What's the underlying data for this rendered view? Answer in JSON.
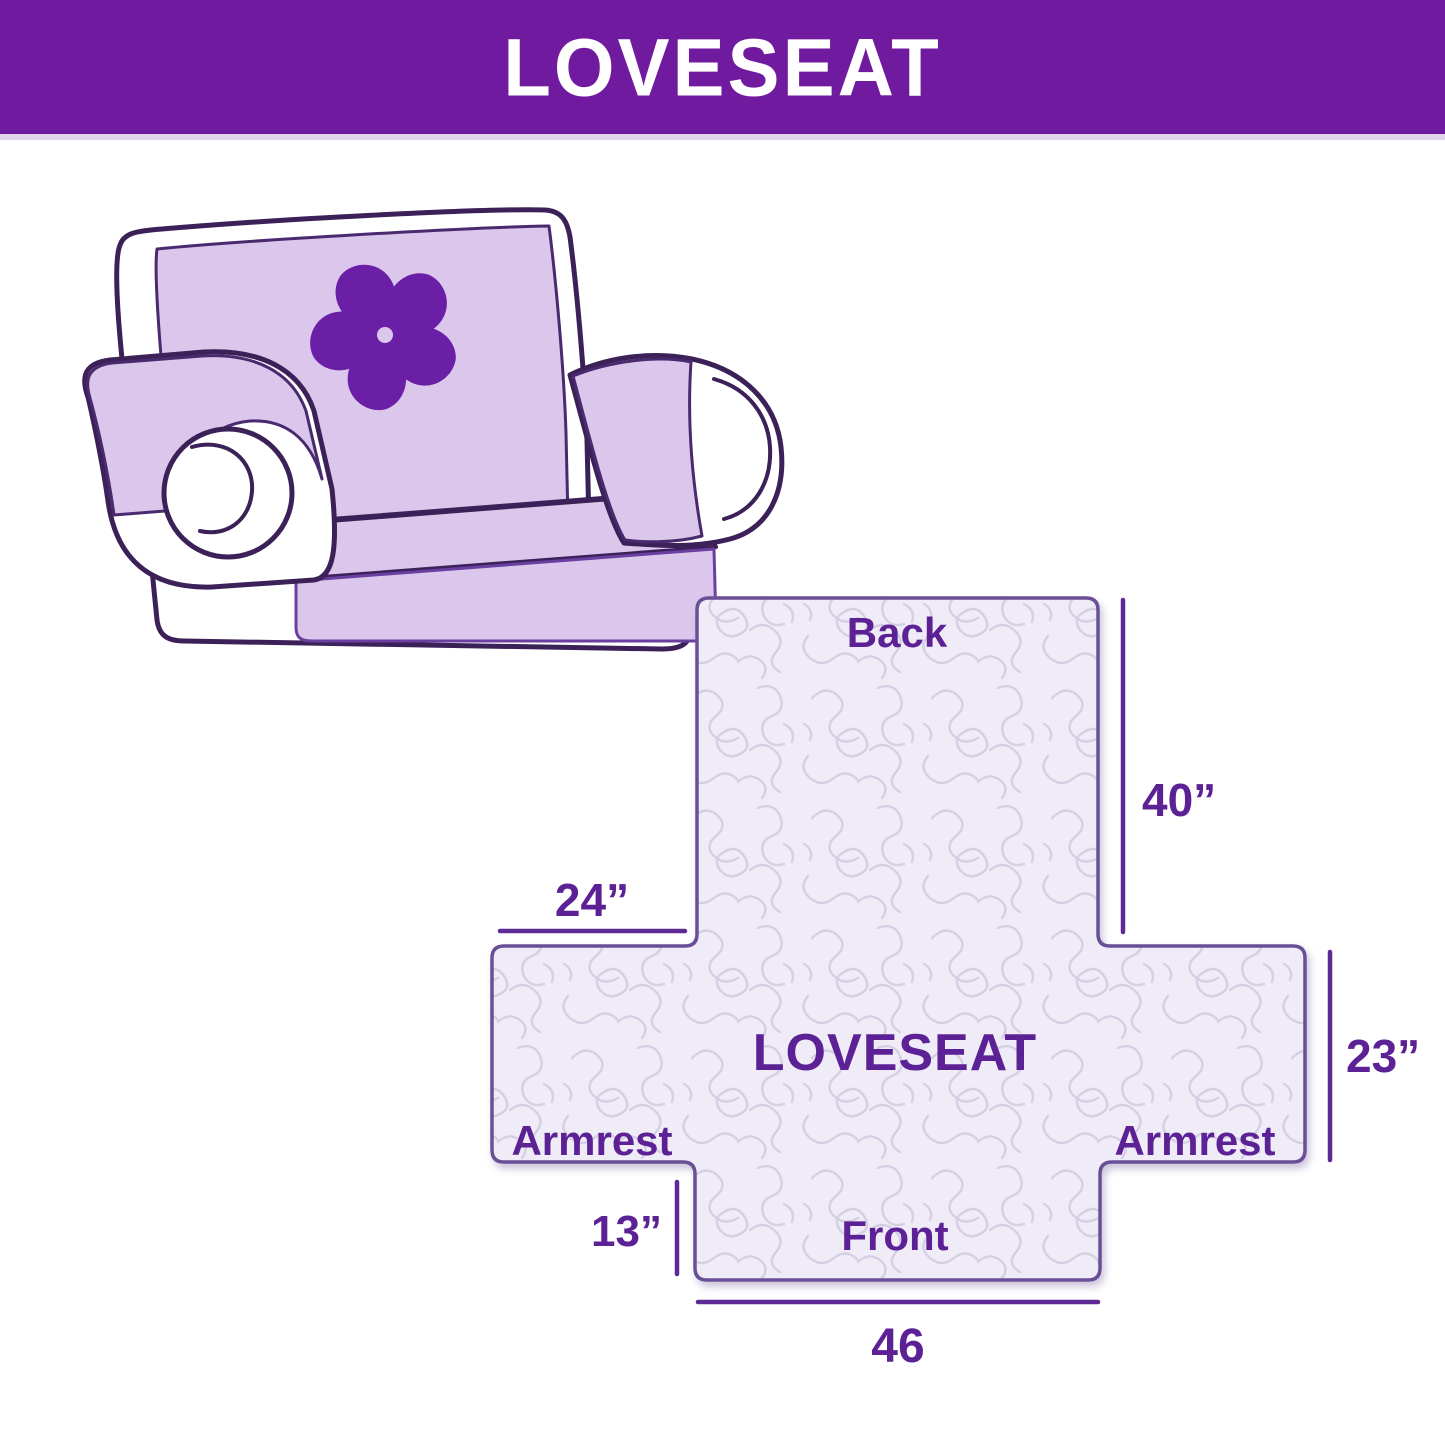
{
  "header": {
    "title": "LOVESEAT",
    "background_color": "#701aa0",
    "text_color": "#ffffff"
  },
  "illustration": {
    "description": "line-art loveseat sofa wearing a lavender protective cover with pinwheel flower logo",
    "cover_color": "#dcc7ec",
    "outline_color": "#3b2158",
    "logo_color": "#6b1fa6"
  },
  "diagram": {
    "center_label": "LOVESEAT",
    "back_label": "Back",
    "front_label": "Front",
    "armrest_left_label": "Armrest",
    "armrest_right_label": "Armrest",
    "dim_back_height": "40”",
    "dim_back_width": "24”",
    "dim_side_depth": "23”",
    "dim_front_drop": "13”",
    "dim_front_width": "46",
    "shape_fill_color": "#efecf7",
    "quilt_pattern_color": "#d5cfe3",
    "shape_outline_color": "#6a5096",
    "label_color": "#5c2195"
  }
}
